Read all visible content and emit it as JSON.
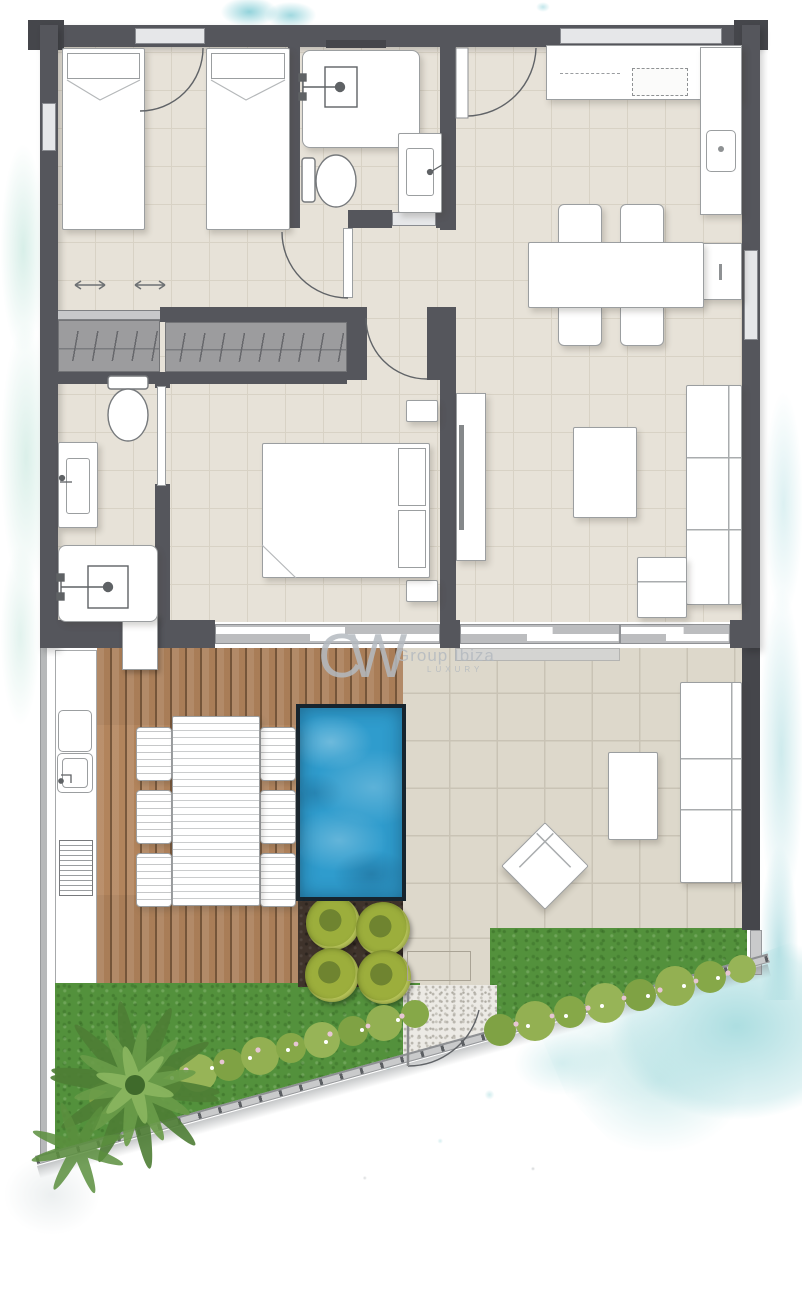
{
  "watermark": {
    "logo": "CW",
    "brand": "Group Ibiza",
    "tagline": "LUXURY"
  },
  "palette": {
    "wall": "#55565c",
    "wall_dark": "#45464b",
    "glass": "#bcbdbf",
    "floor": "#e7e2d8",
    "floor_line": "#d8d2c5",
    "patio": "#ddd8cb",
    "patio_line": "#c9c3b5",
    "furniture": "#ffffff",
    "furniture_line": "#9b9ea0",
    "wardrobe": "#9c9c9e",
    "deck": "#b2845c",
    "pool": "#2f9ccd",
    "pool_edge": "#16242e",
    "soil": "#3f332b",
    "bush": "#9cae3c",
    "grass": "#53913c",
    "hedge": "#8fae4e",
    "gravel": "#eceae5",
    "fence": "#c9cacb",
    "watercolor": "#a8dcdf",
    "watermark": "#b4bac0"
  },
  "plan": {
    "level": "ground-floor-with-terrace",
    "rooms": [
      {
        "name": "bedroom-1",
        "furniture": [
          "single-bed",
          "single-bed",
          "sliding-wardrobe",
          "wardrobe"
        ]
      },
      {
        "name": "bathroom-1",
        "furniture": [
          "shower",
          "toilet",
          "washbasin"
        ]
      },
      {
        "name": "entry-kitchen-dining",
        "furniture": [
          "entrance-door",
          "kitchen-counter",
          "cooktop",
          "kitchen-sink",
          "base-cabinet",
          "dining-table",
          "chair",
          "chair",
          "chair",
          "chair"
        ]
      },
      {
        "name": "bathroom-2",
        "furniture": [
          "toilet",
          "washbasin",
          "shower"
        ]
      },
      {
        "name": "master-bedroom",
        "furniture": [
          "double-bed",
          "nightstand",
          "nightstand",
          "sliding-glass-door"
        ]
      },
      {
        "name": "living-room",
        "furniture": [
          "tv-unit",
          "coffee-table",
          "corner-sofa",
          "sliding-glass-door"
        ]
      },
      {
        "name": "terrace",
        "furniture": [
          "outdoor-kitchen",
          "outdoor-sink",
          "barbecue",
          "deck-dining-table",
          "deck-chairs-x6",
          "plunge-pool",
          "planter-bed",
          "sun-lounger",
          "side-table",
          "outdoor-sofa",
          "doormat"
        ]
      },
      {
        "name": "garden",
        "furniture": [
          "lawn",
          "flowering-hedge",
          "palm-plant",
          "gravel-path",
          "entrance-gate",
          "boundary-fence"
        ]
      }
    ]
  }
}
